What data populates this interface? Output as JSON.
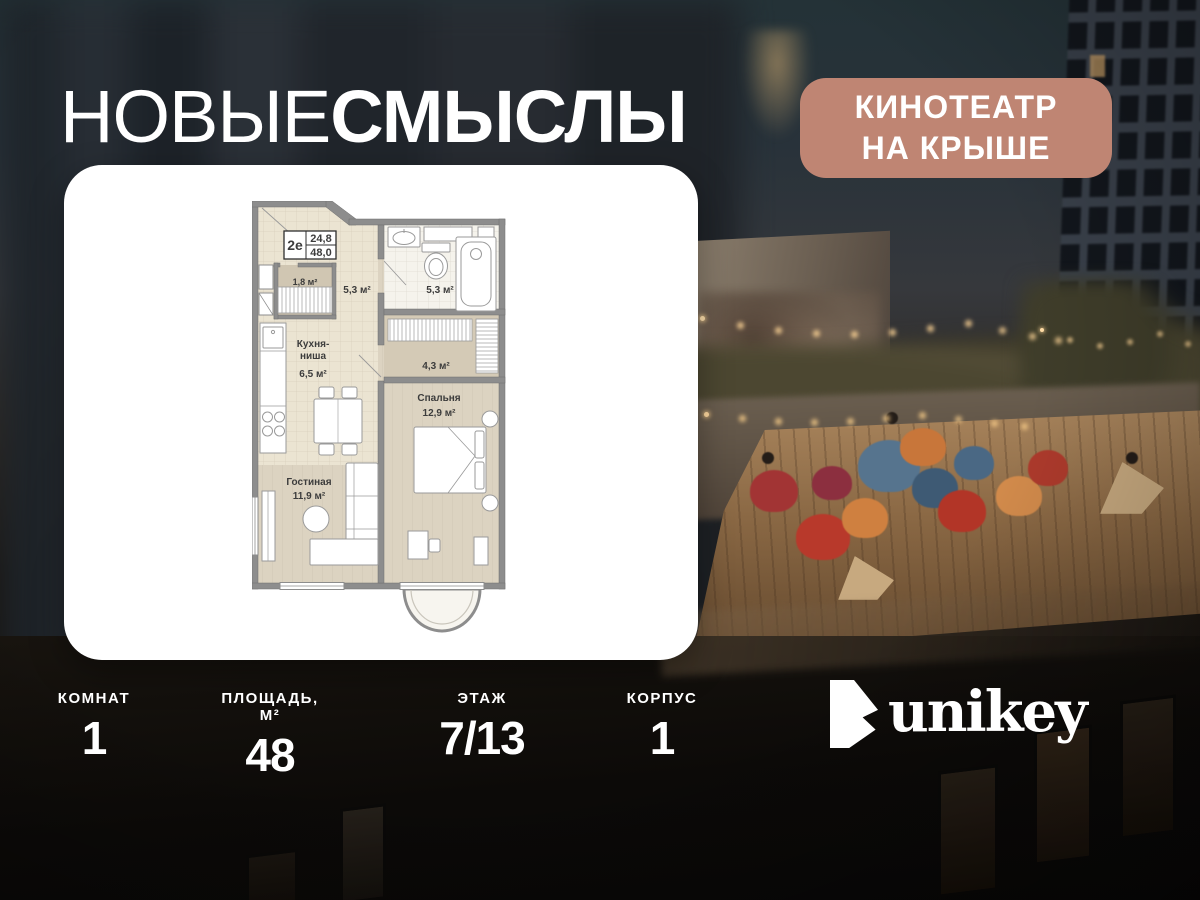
{
  "header": {
    "title_thin": "НОВЫЕ",
    "title_bold": "СМЫСЛЫ",
    "badge_line1": "КИНОТЕАТР",
    "badge_line2": "НА КРЫШЕ"
  },
  "floorplan": {
    "unit": {
      "type": "2е",
      "area_top": "24,8",
      "area_bottom": "48,0"
    },
    "rooms": {
      "wardrobe": {
        "area": "1,8 м²"
      },
      "hall": {
        "area": "5,3 м²"
      },
      "bathroom": {
        "area": "5,3 м²"
      },
      "closet": {
        "area": "4,3 м²"
      },
      "kitchen": {
        "name_line1": "Кухня-",
        "name_line2": "ниша",
        "area": "6,5 м²"
      },
      "living": {
        "name": "Гостиная",
        "area": "11,9 м²"
      },
      "bedroom": {
        "name": "Спальня",
        "area": "12,9 м²"
      }
    }
  },
  "stats": [
    {
      "label": "КОМНАТ",
      "value": "1"
    },
    {
      "label": "ПЛОЩАДЬ, М²",
      "value": "48"
    },
    {
      "label": "ЭТАЖ",
      "value": "7/13"
    },
    {
      "label": "КОРПУС",
      "value": "1"
    }
  ],
  "brand": {
    "name": "unikey"
  },
  "colors": {
    "badge_bg": "#bf8573",
    "card_bg": "#ffffff",
    "wall_gray": "#8d8d8d",
    "tile_floor": "#ebe4d2",
    "wood_floor": "#dcd3c1"
  }
}
